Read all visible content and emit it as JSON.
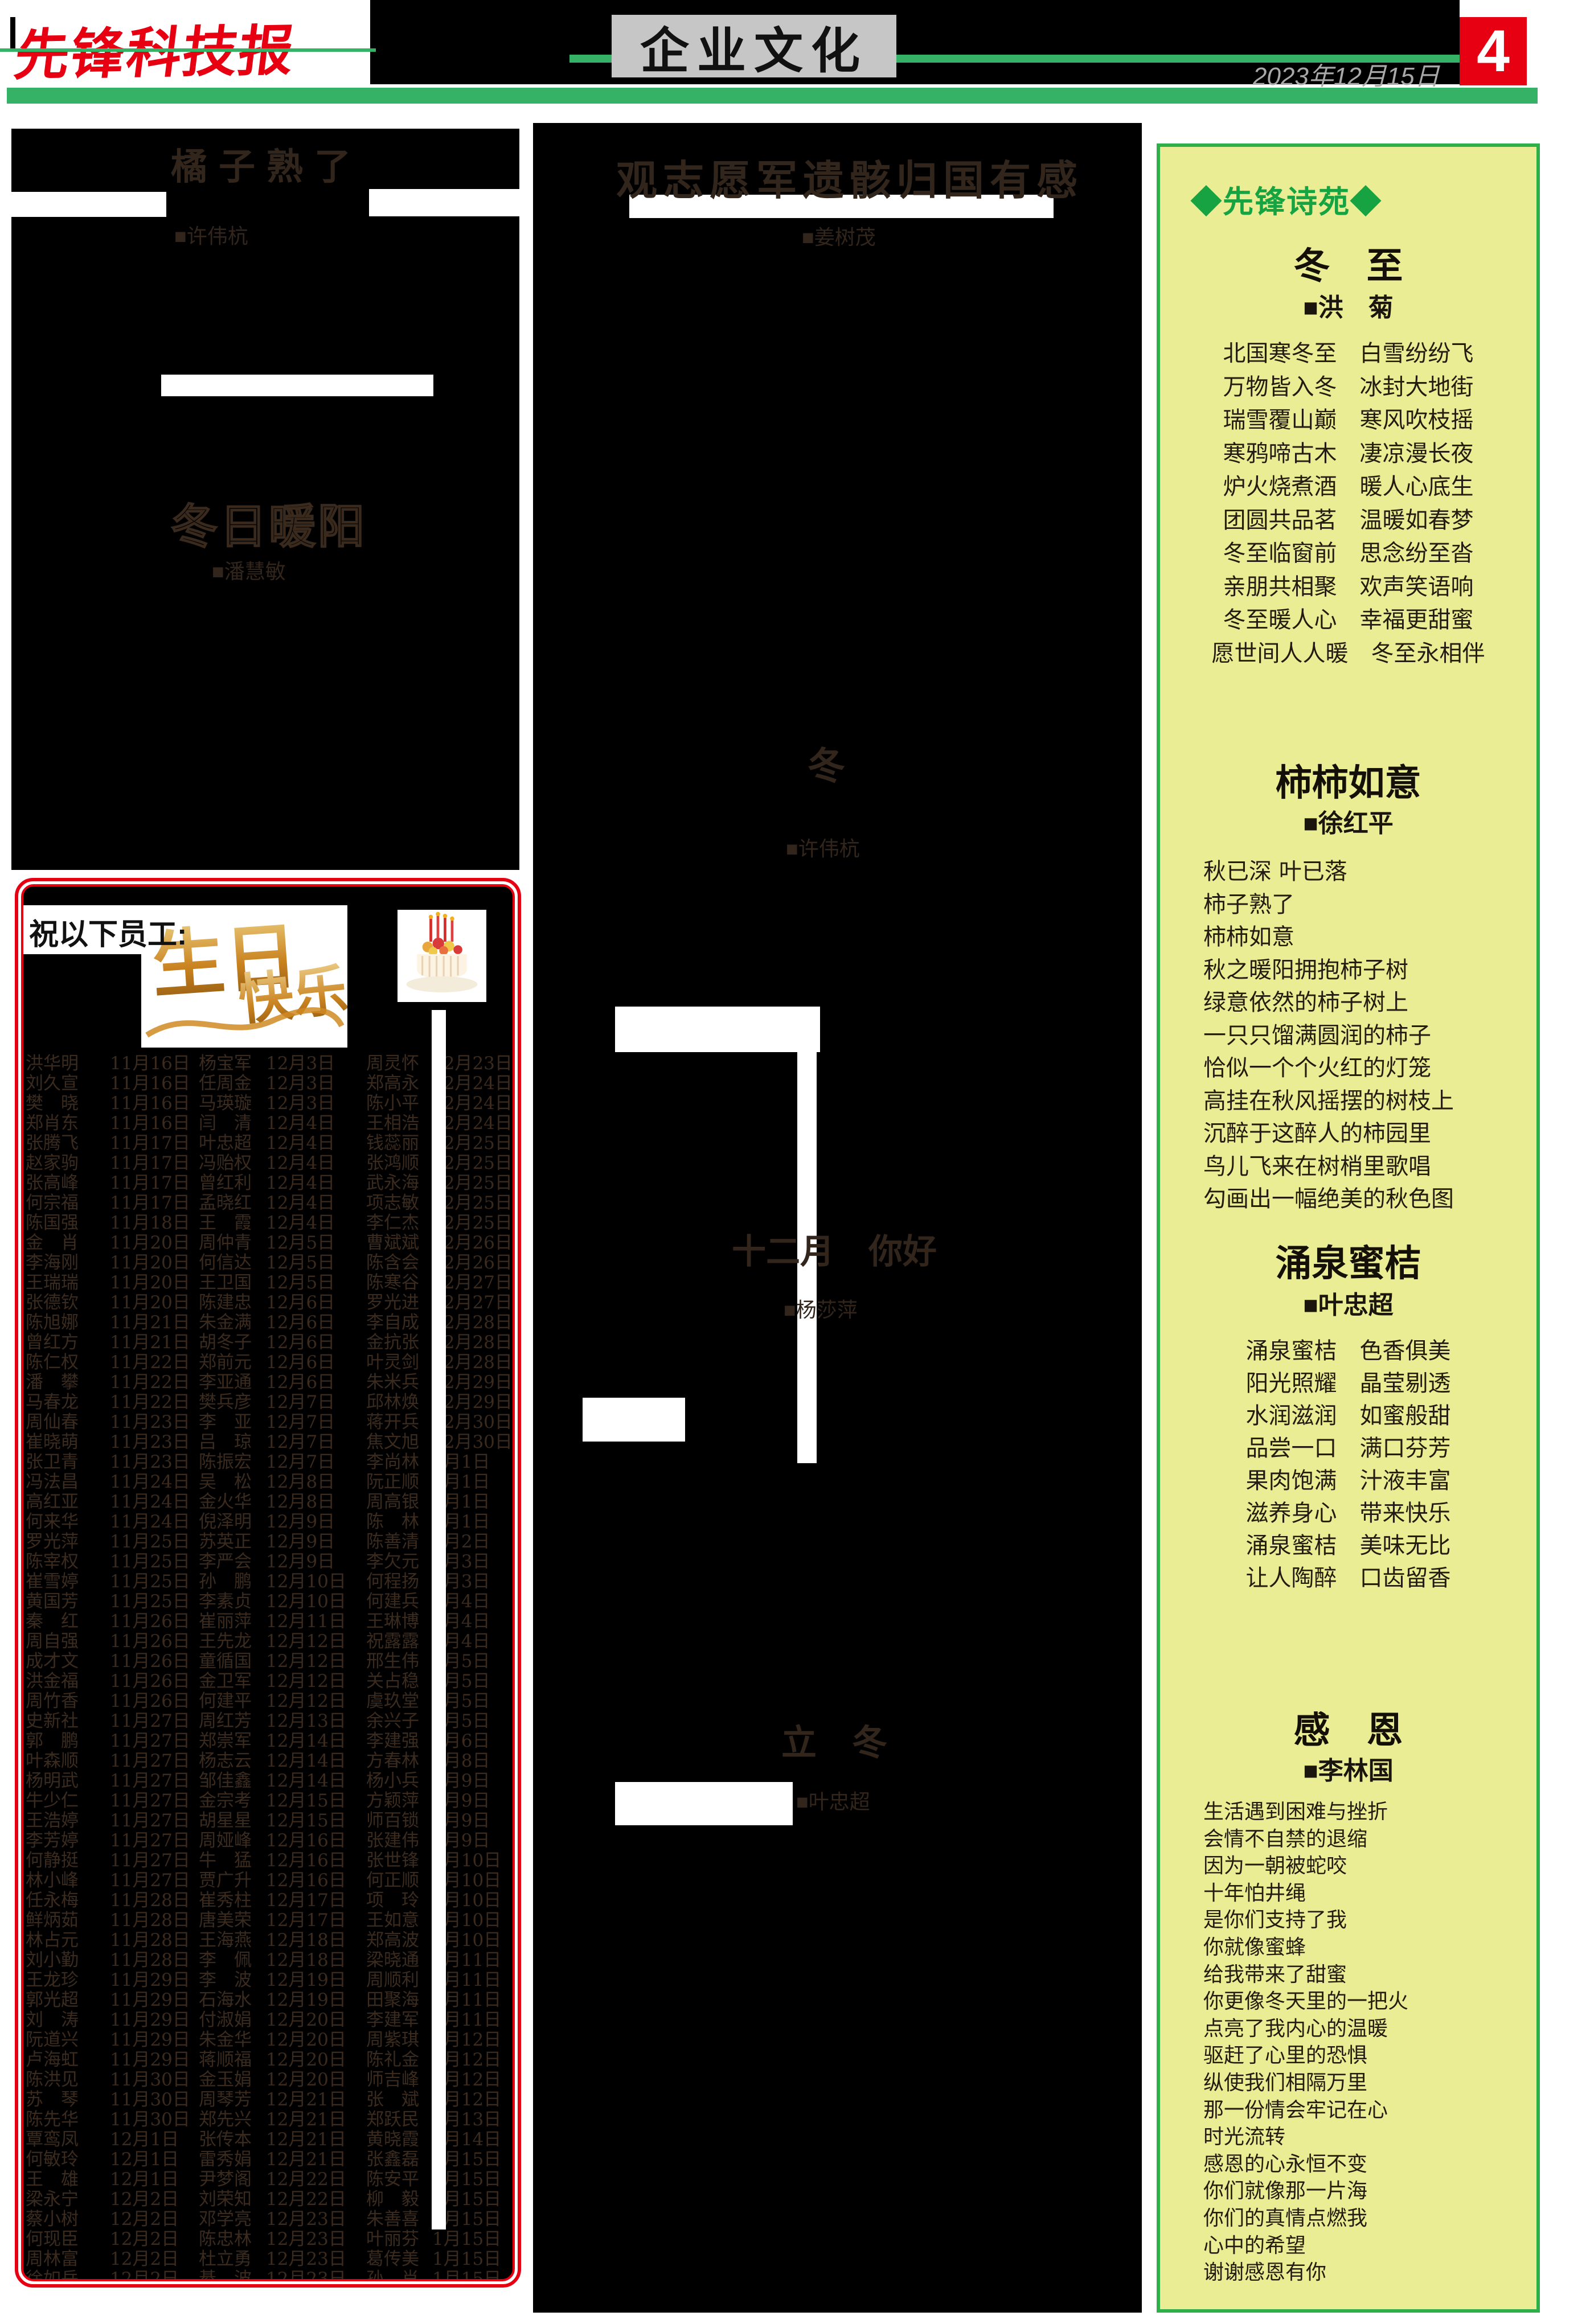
{
  "masthead": {
    "logo": "先锋科技报",
    "section": "企业文化",
    "date": "2023年12月15日",
    "page_number": "4"
  },
  "articles": [
    {
      "title": "橘子熟了",
      "author": "■许伟杭"
    },
    {
      "title": "冬日暖阳",
      "author": "■潘慧敏"
    },
    {
      "title": "观志愿军遗骸归国有感",
      "author": "■姜树茂"
    },
    {
      "title": "冬",
      "author": "■许伟杭"
    },
    {
      "title": "十二月　你好",
      "author": "■杨莎萍"
    },
    {
      "title": "立　冬",
      "author": "■叶忠超"
    }
  ],
  "poetry_panel": {
    "label": "◆先锋诗苑◆",
    "poems": [
      {
        "title": "冬　至",
        "author": "■洪　菊",
        "lines": [
          "北国寒冬至　白雪纷纷飞",
          "万物皆入冬　冰封大地街",
          "瑞雪覆山巅　寒风吹枝摇",
          "寒鸦啼古木　凄凉漫长夜",
          "炉火烧煮酒　暖人心底生",
          "团圆共品茗　温暖如春梦",
          "冬至临窗前　思念纷至沓",
          "亲朋共相聚　欢声笑语响",
          "冬至暖人心　幸福更甜蜜",
          "愿世间人人暖　冬至永相伴"
        ]
      },
      {
        "title": "柿柿如意",
        "author": "■徐红平",
        "lines": [
          "秋已深 叶已落",
          "柿子熟了",
          "柿柿如意",
          "秋之暖阳拥抱柿子树",
          "绿意依然的柿子树上",
          "一只只馏满圆润的柿子",
          "恰似一个个火红的灯笼",
          "高挂在秋风摇摆的树枝上",
          "沉醉于这醉人的柿园里",
          "鸟儿飞来在树梢里歌唱",
          "勾画出一幅绝美的秋色图"
        ]
      },
      {
        "title": "涌泉蜜桔",
        "author": "■叶忠超",
        "lines": [
          "涌泉蜜桔　色香俱美",
          "阳光照耀　晶莹剔透",
          "水润滋润　如蜜般甜",
          "品尝一口　满口芬芳",
          "果肉饱满　汁液丰富",
          "滋养身心　带来快乐",
          "涌泉蜜桔　美味无比",
          "让人陶醉　口齿留香"
        ]
      },
      {
        "title": "感　恩",
        "author": "■李林国",
        "lines": [
          "生活遇到困难与挫折",
          "会情不自禁的退缩",
          "因为一朝被蛇咬",
          "十年怕井绳",
          "是你们支持了我",
          "你就像蜜蜂",
          "给我带来了甜蜜",
          "你更像冬天里的一把火",
          "点亮了我内心的温暖",
          "驱赶了心里的恐惧",
          "纵使我们相隔万里",
          "那一份情会牢记在心",
          "时光流转",
          "感恩的心永恒不变",
          "你们就像那一片海",
          "你们的真情点燃我",
          "心中的希望",
          "谢谢感恩有你"
        ]
      }
    ]
  },
  "birthday_box": {
    "heading": "祝以下员工:",
    "artwork_text": "生日快乐",
    "rows": [
      [
        "洪华明",
        "11月16日",
        "杨宝军",
        "12月3日",
        "周灵怀",
        "12月23日"
      ],
      [
        "刘久宣",
        "11月16日",
        "任周金",
        "12月3日",
        "郑高永",
        "12月24日"
      ],
      [
        "樊　晓",
        "11月16日",
        "马瑛璇",
        "12月3日",
        "陈小平",
        "12月24日"
      ],
      [
        "郑肖东",
        "11月16日",
        "闫　清",
        "12月4日",
        "王相浩",
        "12月24日"
      ],
      [
        "张腾飞",
        "11月17日",
        "叶忠超",
        "12月4日",
        "钱蕊丽",
        "12月25日"
      ],
      [
        "赵家驹",
        "11月17日",
        "冯贻权",
        "12月4日",
        "张鸿顺",
        "12月25日"
      ],
      [
        "张高峰",
        "11月17日",
        "曾红利",
        "12月4日",
        "武永海",
        "12月25日"
      ],
      [
        "何宗福",
        "11月17日",
        "孟晓红",
        "12月4日",
        "项志敏",
        "12月25日"
      ],
      [
        "陈国强",
        "11月18日",
        "王　霞",
        "12月4日",
        "李仁杰",
        "12月25日"
      ],
      [
        "金　肖",
        "11月20日",
        "周仲青",
        "12月5日",
        "曹斌斌",
        "12月26日"
      ],
      [
        "李海刚",
        "11月20日",
        "何信达",
        "12月5日",
        "陈含会",
        "12月26日"
      ],
      [
        "王瑞瑞",
        "11月20日",
        "王卫国",
        "12月5日",
        "陈寒谷",
        "12月27日"
      ],
      [
        "张德钦",
        "11月20日",
        "陈建忠",
        "12月6日",
        "罗光进",
        "12月27日"
      ],
      [
        "陈旭娜",
        "11月21日",
        "朱金满",
        "12月6日",
        "李自成",
        "12月28日"
      ],
      [
        "曾红方",
        "11月21日",
        "胡冬子",
        "12月6日",
        "金抗张",
        "12月28日"
      ],
      [
        "陈仁权",
        "11月22日",
        "郑前元",
        "12月6日",
        "叶灵剑",
        "12月28日"
      ],
      [
        "潘　攀",
        "11月22日",
        "李亚通",
        "12月6日",
        "朱米兵",
        "12月29日"
      ],
      [
        "马春龙",
        "11月22日",
        "樊兵彦",
        "12月7日",
        "邱林焕",
        "12月29日"
      ],
      [
        "周仙春",
        "11月23日",
        "李　亚",
        "12月7日",
        "蒋开兵",
        "12月30日"
      ],
      [
        "崔晓萌",
        "11月23日",
        "吕　琼",
        "12月7日",
        "焦文旭",
        "12月30日"
      ],
      [
        "张卫青",
        "11月23日",
        "陈振宏",
        "12月7日",
        "李尚林",
        "1月1日"
      ],
      [
        "冯法昌",
        "11月24日",
        "吴　松",
        "12月8日",
        "阮正顺",
        "1月1日"
      ],
      [
        "高红亚",
        "11月24日",
        "金火华",
        "12月8日",
        "周高银",
        "1月1日"
      ],
      [
        "何来华",
        "11月24日",
        "倪泽明",
        "12月9日",
        "陈　林",
        "1月1日"
      ],
      [
        "罗光萍",
        "11月25日",
        "苏英正",
        "12月9日",
        "陈善清",
        "1月2日"
      ],
      [
        "陈宰权",
        "11月25日",
        "李严会",
        "12月9日",
        "李欠元",
        "1月3日"
      ],
      [
        "崔雪婷",
        "11月25日",
        "孙　鹏",
        "12月10日",
        "何程扬",
        "1月3日"
      ],
      [
        "黄国芳",
        "11月25日",
        "李素贞",
        "12月10日",
        "何建兵",
        "1月4日"
      ],
      [
        "秦　红",
        "11月26日",
        "崔丽萍",
        "12月11日",
        "王琳博",
        "1月4日"
      ],
      [
        "周自强",
        "11月26日",
        "王先龙",
        "12月12日",
        "祝露露",
        "1月4日"
      ],
      [
        "成才文",
        "11月26日",
        "童循国",
        "12月12日",
        "邢生伟",
        "1月5日"
      ],
      [
        "洪金福",
        "11月26日",
        "金卫军",
        "12月12日",
        "关占稳",
        "1月5日"
      ],
      [
        "周竹香",
        "11月26日",
        "何建平",
        "12月12日",
        "虞玖堂",
        "1月5日"
      ],
      [
        "史新社",
        "11月27日",
        "周红芳",
        "12月13日",
        "余兴子",
        "1月5日"
      ],
      [
        "郭　鹏",
        "11月27日",
        "郑崇军",
        "12月14日",
        "李建强",
        "1月6日"
      ],
      [
        "叶森顺",
        "11月27日",
        "杨志云",
        "12月14日",
        "方春林",
        "1月8日"
      ],
      [
        "杨明武",
        "11月27日",
        "邹佳鑫",
        "12月14日",
        "杨小兵",
        "1月9日"
      ],
      [
        "牛少仁",
        "11月27日",
        "金宗考",
        "12月15日",
        "方颖萍",
        "1月9日"
      ],
      [
        "王浩婷",
        "11月27日",
        "胡星星",
        "12月15日",
        "师百锁",
        "1月9日"
      ],
      [
        "李芳婷",
        "11月27日",
        "周娅峰",
        "12月16日",
        "张建伟",
        "1月9日"
      ],
      [
        "何静挺",
        "11月27日",
        "牛　猛",
        "12月16日",
        "张世锋",
        "1月10日"
      ],
      [
        "林小峰",
        "11月27日",
        "贾广升",
        "12月16日",
        "何正顺",
        "1月10日"
      ],
      [
        "任永梅",
        "11月28日",
        "崔秀柱",
        "12月17日",
        "项　玲",
        "1月10日"
      ],
      [
        "鲜炳茹",
        "11月28日",
        "唐美荣",
        "12月17日",
        "王如意",
        "1月10日"
      ],
      [
        "林占元",
        "11月28日",
        "王海燕",
        "12月18日",
        "郑高波",
        "1月10日"
      ],
      [
        "刘小勤",
        "11月28日",
        "李　佩",
        "12月18日",
        "梁晓通",
        "1月11日"
      ],
      [
        "王龙珍",
        "11月29日",
        "李　波",
        "12月19日",
        "周顺利",
        "1月11日"
      ],
      [
        "郭光超",
        "11月29日",
        "石海水",
        "12月19日",
        "田聚海",
        "1月11日"
      ],
      [
        "刘　涛",
        "11月29日",
        "付淑娟",
        "12月20日",
        "李建军",
        "1月11日"
      ],
      [
        "阮道兴",
        "11月29日",
        "朱金华",
        "12月20日",
        "周紫琪",
        "1月12日"
      ],
      [
        "卢海虹",
        "11月29日",
        "蒋顺福",
        "12月20日",
        "陈礼金",
        "1月12日"
      ],
      [
        "陈洪见",
        "11月30日",
        "金玉娟",
        "12月20日",
        "师吉峰",
        "1月12日"
      ],
      [
        "苏　琴",
        "11月30日",
        "周琴芳",
        "12月21日",
        "张　斌",
        "1月12日"
      ],
      [
        "陈先华",
        "11月30日",
        "郑先兴",
        "12月21日",
        "郑跃民",
        "1月13日"
      ],
      [
        "覃鸾凤",
        "12月1日",
        "张传本",
        "12月21日",
        "黄晓霞",
        "1月14日"
      ],
      [
        "何敏玲",
        "12月1日",
        "雷秀娟",
        "12月21日",
        "张鑫磊",
        "1月15日"
      ],
      [
        "王　雄",
        "12月1日",
        "尹梦阁",
        "12月22日",
        "陈安平",
        "1月15日"
      ],
      [
        "梁永宁",
        "12月2日",
        "刘荣知",
        "12月22日",
        "柳　毅",
        "1月15日"
      ],
      [
        "蔡小树",
        "12月2日",
        "邓学亮",
        "12月23日",
        "朱善喜",
        "1月15日"
      ],
      [
        "何现臣",
        "12月2日",
        "陈忠林",
        "12月23日",
        "叶丽芬",
        "1月15日"
      ],
      [
        "周林富",
        "12月2日",
        "杜立勇",
        "12月23日",
        "葛传美",
        "1月15日"
      ],
      [
        "徐如岳",
        "12月2日",
        "綦　波",
        "12月23日",
        "孙　肖",
        "1月15日"
      ]
    ]
  }
}
